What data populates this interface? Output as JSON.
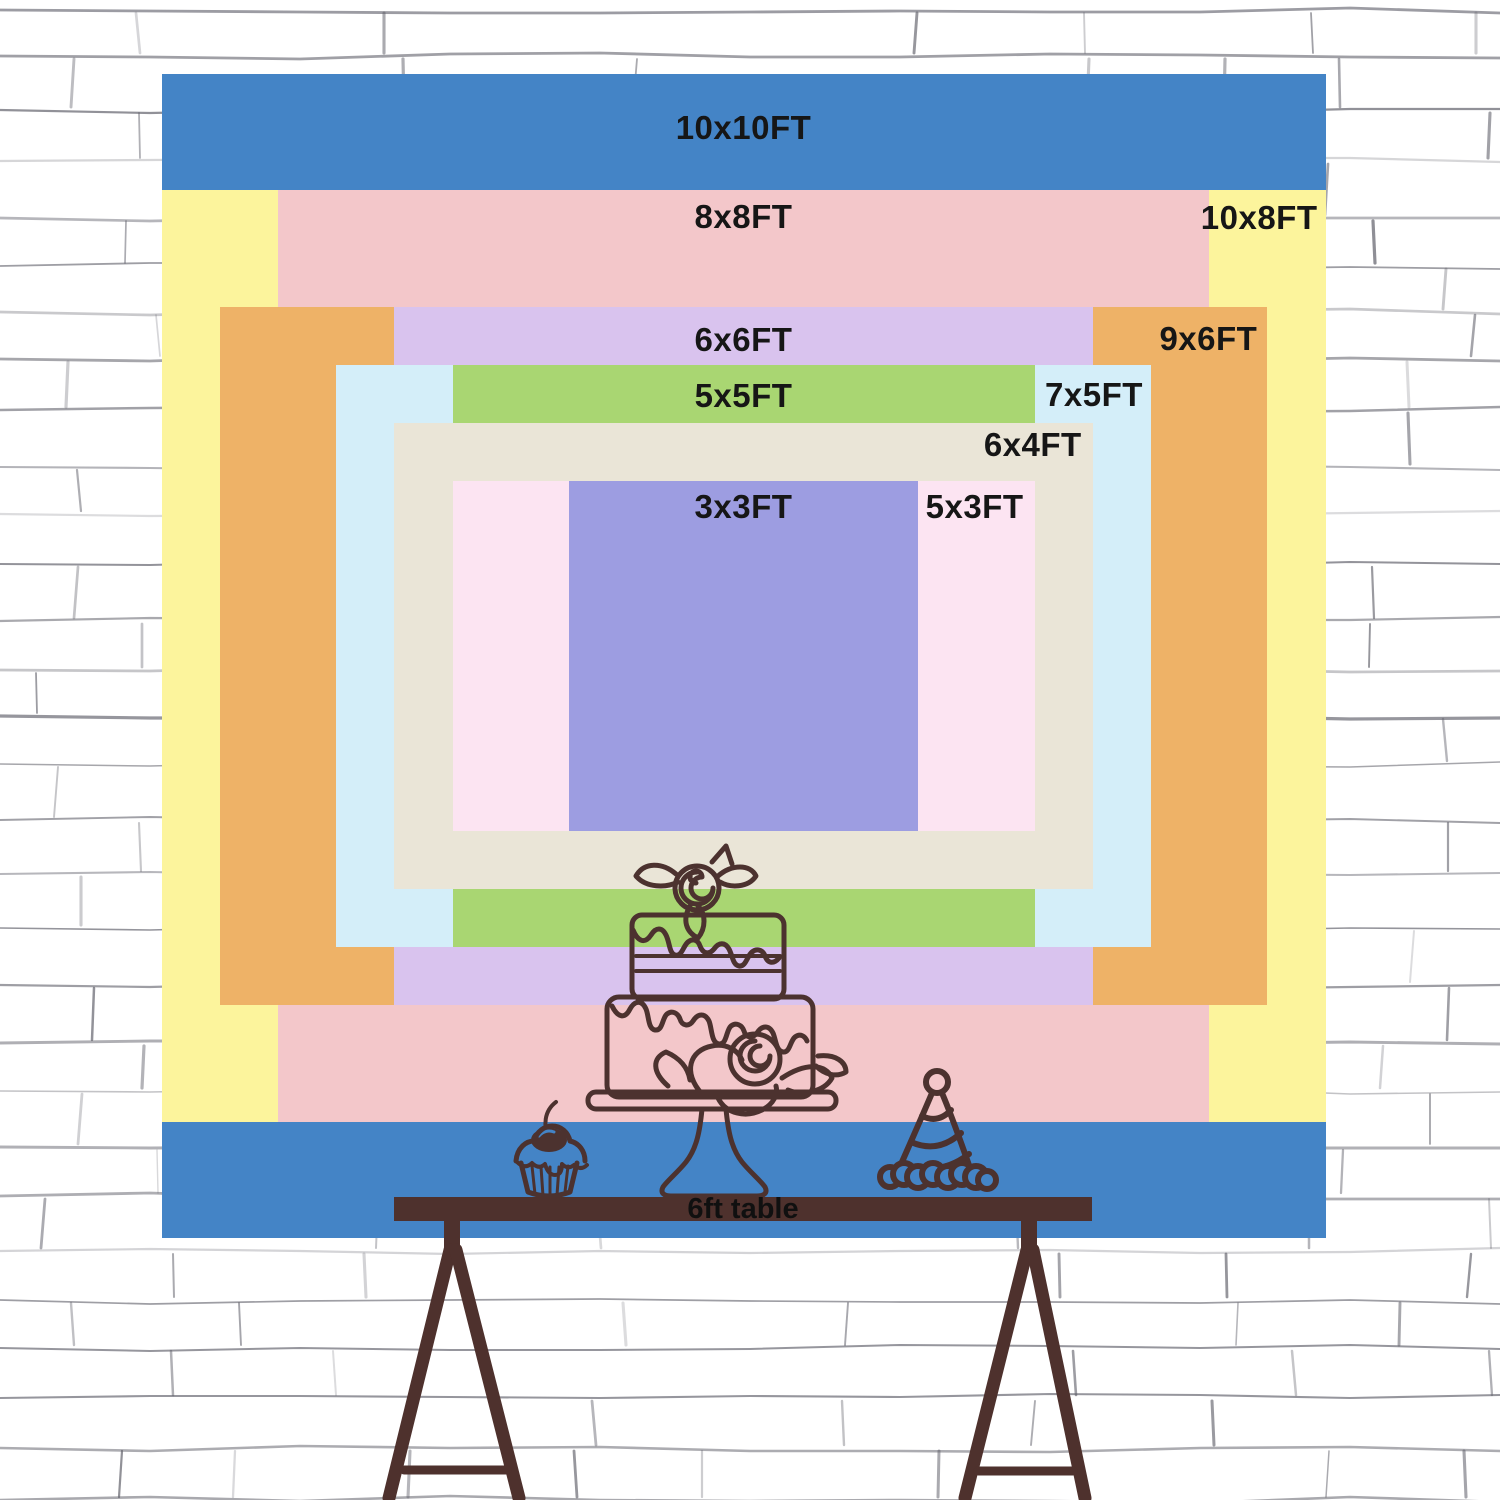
{
  "backdrop": {
    "sizes": [
      {
        "label": "10x10FT",
        "width_ft": 10,
        "height_ft": 10,
        "color": "#4484c6"
      },
      {
        "label": "10x8FT",
        "width_ft": 10,
        "height_ft": 8,
        "color": "#fcf49c"
      },
      {
        "label": "8x8FT",
        "width_ft": 8,
        "height_ft": 8,
        "color": "#f3c7ca"
      },
      {
        "label": "9x6FT",
        "width_ft": 9,
        "height_ft": 6,
        "color": "#eeb267"
      },
      {
        "label": "6x6FT",
        "width_ft": 6,
        "height_ft": 6,
        "color": "#d9c3ee"
      },
      {
        "label": "7x5FT",
        "width_ft": 7,
        "height_ft": 5,
        "color": "#d4eef9"
      },
      {
        "label": "5x5FT",
        "width_ft": 5,
        "height_ft": 5,
        "color": "#a9d672"
      },
      {
        "label": "6x4FT",
        "width_ft": 6,
        "height_ft": 4,
        "color": "#eae5d7"
      },
      {
        "label": "5x3FT",
        "width_ft": 5,
        "height_ft": 3,
        "color": "#fce4f2"
      },
      {
        "label": "3x3FT",
        "width_ft": 3,
        "height_ft": 3,
        "color": "#9d9de1"
      }
    ]
  },
  "table": {
    "label": "6ft table",
    "length_ft": 6,
    "color": "#4e312d"
  },
  "decorations": [
    {
      "name": "cupcake-icon"
    },
    {
      "name": "cake-icon"
    },
    {
      "name": "party-hat-icon"
    }
  ],
  "colors": {
    "line_art": "#4c322f",
    "label_text": "#161616",
    "wall_line": "#60606a",
    "wall_bg": "#ffffff"
  }
}
